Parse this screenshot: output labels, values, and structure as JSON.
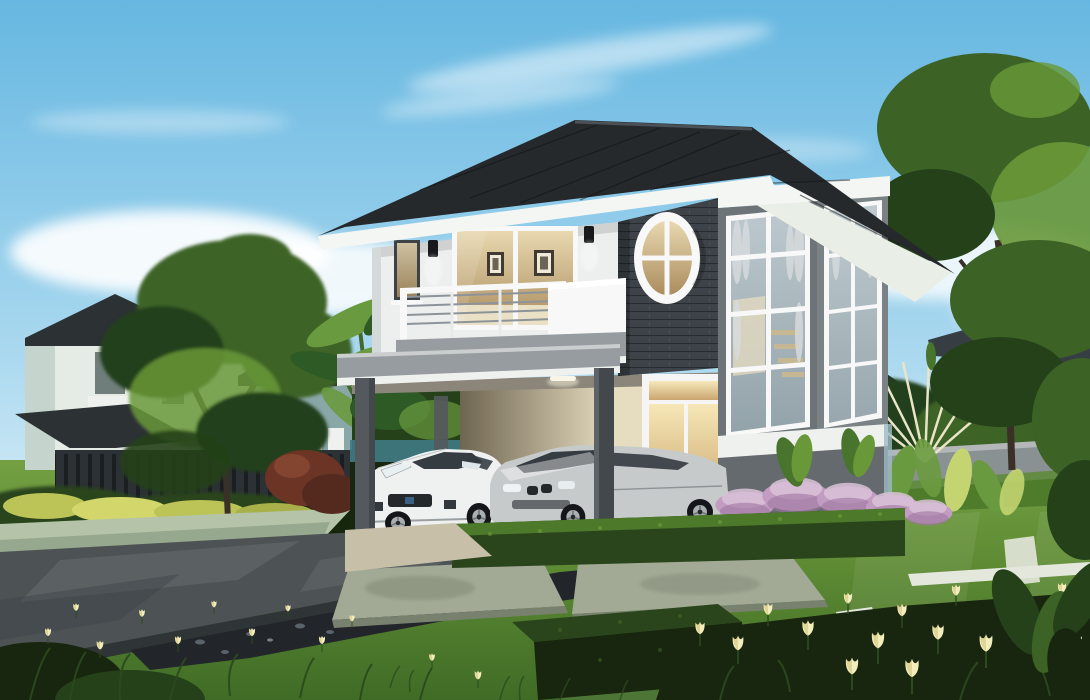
{
  "meta": {
    "title": "3D exterior rendering of a modern two-storey house",
    "scene_type": "architectural visualization, daytime"
  },
  "colors": {
    "sky_top": "#66b7e1",
    "sky_mid": "#a9d8ef",
    "sky_low": "#e3f2fa",
    "cloud_white": "#ffffff",
    "roof_tile": "#26292c",
    "roof_ridge": "#4a5055",
    "fascia_white": "#f3f6f2",
    "soffit_white": "#e9eee6",
    "wall_white": "#edefee",
    "wall_shade": "#d4dad9",
    "brick_charcoal": "#3d4349",
    "bay_front_gray": "#6d7478",
    "bay_side_gray": "#7b8286",
    "bay_lower_gray": "#646a6e",
    "bay_trim_blue": "#9fbac5",
    "frame_white": "#f7f8f7",
    "glass_warm_hi": "#e8d8b0",
    "glass_warm_lo": "#ab8c5e",
    "glass_cool_hi": "#bcc8cd",
    "glass_cool_lo": "#93a3aa",
    "curtain_gray": "#d8dcde",
    "slab_gray": "#969c9f",
    "band_white": "#eef1ee",
    "column_gray": "#54595d",
    "column_dark": "#43484c",
    "interior_hi": "#e6dcc0",
    "interior_lo": "#6f6652",
    "door_glow_hi": "#f6e7b8",
    "door_glow_lo": "#c8a168",
    "door_white": "#f4f5f4",
    "fence_teal": "#3f7a85",
    "car_white": "#eff1f0",
    "car_white_shade": "#c3c8c8",
    "car_glass": "#363d42",
    "car_grille": "#24282b",
    "car_badge_blue": "#3c5f86",
    "car_silver": "#c6cacb",
    "car_silver_dark": "#8e9396",
    "tyre_black": "#141619",
    "rim_silver": "#aaafb1",
    "lawn_far": "#74a043",
    "lawn_mid": "#5d8a33",
    "lawn_dark": "#3f6b26",
    "lawn_light": "#7fae49",
    "hedge_top": "#4f7c2b",
    "hedge_mid": "#2a451c",
    "hedge_dark": "#18260f",
    "tree_green": "#3c6325",
    "tree_light": "#699838",
    "tree_dark": "#24411a",
    "trunk_brown": "#3a3028",
    "banana_green": "#2e5a25",
    "banana_light": "#6a9a3f",
    "drive_gray": "#4d5255",
    "drive_light": "#767c7e",
    "drive_dark": "#2f3436",
    "gravel_black": "#22262a",
    "gravel_stone": "#5a626a",
    "slab_stone": "#a2aa96",
    "slab_stone_dark": "#78806e",
    "strip_white": "#e3e7dc",
    "curb_green": "#b5c4a9",
    "muhly_pink": "#c29dc1",
    "muhly_light": "#dbc2d8",
    "muhly_dark": "#9e77a0",
    "flower_cream": "#f2edbc",
    "flower_shade": "#d6c87e",
    "stem_green": "#2c4a1e",
    "neighbor_wall": "#e5ece6",
    "neighbor_wall2": "#c5d5cd",
    "neighbor_roof": "#2c3134",
    "neighbor_glass": "#6f7e7a",
    "teal_house": "#8aa7a8",
    "fence_dark": "#2b3135",
    "fence_bar": "#1a1e21",
    "bg_wall_gray": "#8a9193",
    "white_house": "#eef1ee",
    "palm_stem_cream": "#e9e5c6",
    "palm_leaf_green": "#49742e",
    "shrub_yellow": "#bcc357",
    "shrub_red": "#6b3425"
  },
  "scene": {
    "sky": "clear blue sky with wispy white clouds",
    "main_house": {
      "style": "modern two-storey detached house",
      "features": [
        "dark hipped tile roof with white fascia",
        "white upper facade with sliding glass door and framed pictures inside",
        "balcony with steel bar railing and white parapet",
        "charcoal brick accent wall with white oval window",
        "double-height corner window bay with white mullions and curtains",
        "flat-roof carport on square gray columns with ceiling light",
        "glazed entry double door glowing warm",
        "two black wall sconces"
      ]
    },
    "vehicles": [
      {
        "label": "white sports car parked under carport"
      },
      {
        "label": "silver sedan parked beside it"
      }
    ],
    "garden": [
      "manicured striped lawn",
      "trimmed box hedges",
      "pink muhly grass drifts",
      "cream tulip flower beds",
      "large rectangular stepping slabs",
      "white paving strips",
      "black gravel bed",
      "dark asphalt driveway",
      "light green curb",
      "banana palms",
      "traveller's palm fan",
      "mature shade trees",
      "red-leaf shrub",
      "yellow shrub row"
    ],
    "background": [
      "neighbouring two-storey house with balcony",
      "teal house behind tree",
      "dark vertical-bar fence",
      "gray perimeter wall",
      "distant white gable houses",
      "white lamp post"
    ]
  }
}
